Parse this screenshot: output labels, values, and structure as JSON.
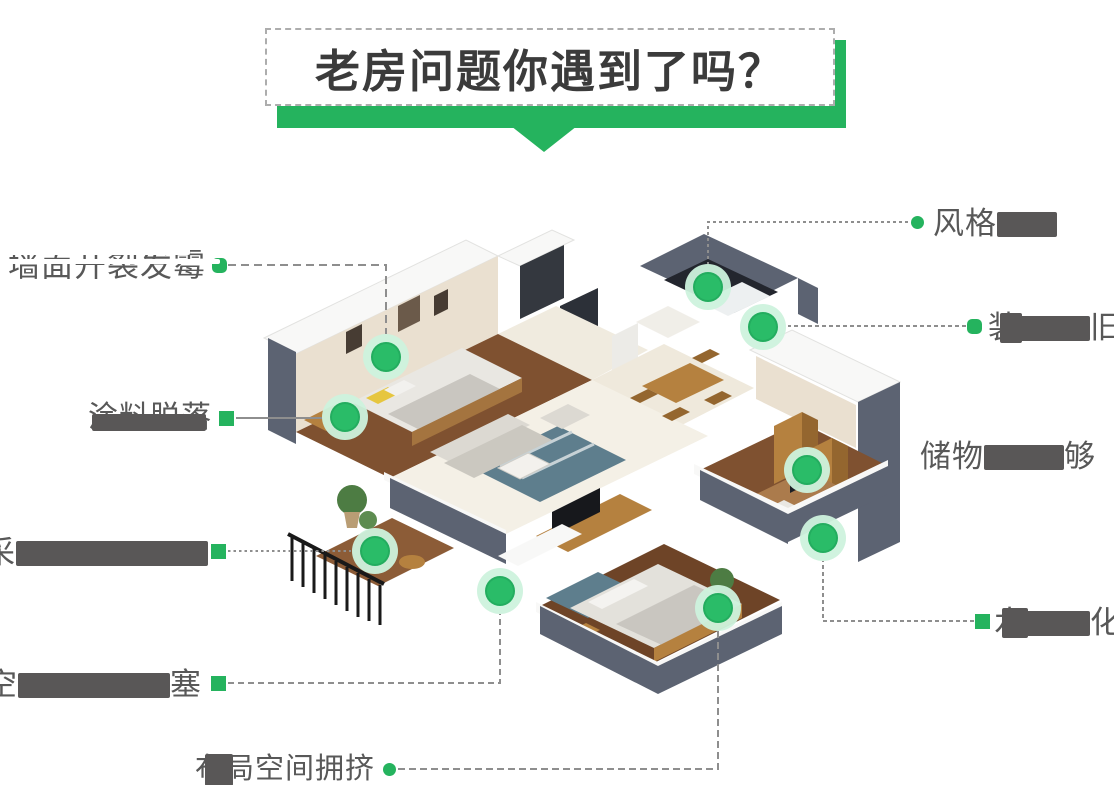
{
  "title": {
    "text": "老房问题你遇到了吗？"
  },
  "colors": {
    "green": "#25b35e",
    "marker_green": "#2abc68",
    "marker_ring": "#cdf2dd",
    "label_text": "#585858",
    "cover_block": "#595757",
    "connector_line": "#8e8e8e",
    "title_text": "#3b3b3b",
    "dashed_border": "#adadad"
  },
  "markers": [
    {
      "x": 386,
      "y": 357
    },
    {
      "x": 345,
      "y": 417
    },
    {
      "x": 375,
      "y": 551
    },
    {
      "x": 500,
      "y": 591
    },
    {
      "x": 708,
      "y": 287
    },
    {
      "x": 763,
      "y": 327
    },
    {
      "x": 807,
      "y": 470
    },
    {
      "x": 823,
      "y": 538
    },
    {
      "x": 718,
      "y": 608
    }
  ],
  "connectors": [
    {
      "path": "M228 265 H386 V334",
      "dash": "8 5"
    },
    {
      "path": "M236 418 H322",
      "dash": "none"
    },
    {
      "path": "M228 551 H351",
      "dash": "2.5 3"
    },
    {
      "path": "M228 683 H500 V614",
      "dash": "6 4"
    },
    {
      "path": "M398 769 H718 V631",
      "dash": "7 4"
    },
    {
      "path": "M908 222 H708 V264",
      "dash": "3 3"
    },
    {
      "path": "M966 326 H788",
      "dash": "4 3"
    },
    {
      "path": "M974 621 H823 V561",
      "dash": "4 3"
    }
  ],
  "dots": [
    {
      "shape": "rounded",
      "x": 219,
      "y": 265
    },
    {
      "shape": "square",
      "x": 226,
      "y": 418
    },
    {
      "shape": "square",
      "x": 218,
      "y": 551
    },
    {
      "shape": "square",
      "x": 218,
      "y": 683
    },
    {
      "shape": "circle",
      "x": 389,
      "y": 769
    },
    {
      "shape": "circle",
      "x": 917,
      "y": 222
    },
    {
      "shape": "rounded",
      "x": 974,
      "y": 326
    },
    {
      "shape": "square",
      "x": 982,
      "y": 621
    }
  ],
  "labels": [
    {
      "id": "wall-crack-mold",
      "x": 8,
      "y": 248,
      "f": 32,
      "segments": [
        {
          "t": "墙面开裂发霉"
        }
      ],
      "overlays": [
        {
          "c": "#ffffff",
          "x": -4,
          "y": -10,
          "w": 186,
          "h": 17
        },
        {
          "c": "#ffffff",
          "x": -4,
          "y": 11,
          "w": 216,
          "h": 5
        }
      ]
    },
    {
      "id": "paint-peeling",
      "x": 88,
      "y": 402,
      "f": 30,
      "segments": [
        {
          "t": "涂料脱落"
        }
      ],
      "overlays": [
        {
          "c": "#595757",
          "x": 4,
          "y": 12,
          "w": 114,
          "h": 17
        }
      ]
    },
    {
      "id": "poor-daylight",
      "x": -16,
      "y": 536,
      "f": 31,
      "segments": [
        {
          "t": "采"
        },
        {
          "b": 192
        }
      ],
      "overlays": []
    },
    {
      "id": "pipes-clogged",
      "x": -14,
      "y": 668,
      "f": 31,
      "segments": [
        {
          "t": "空"
        },
        {
          "b": 152
        },
        {
          "t": "塞"
        }
      ],
      "overlays": []
    },
    {
      "id": "layout-crowded",
      "x": 195,
      "y": 754,
      "f": 29,
      "segments": [
        {
          "t": "布局空间拥挤"
        }
      ],
      "overlays": [
        {
          "c": "#595757",
          "x": 10,
          "y": 0,
          "w": 28,
          "h": 32
        }
      ]
    },
    {
      "id": "style-outdated",
      "x": 933,
      "y": 207,
      "f": 31,
      "segments": [
        {
          "t": "风格"
        },
        {
          "b": 60
        }
      ],
      "overlays": []
    },
    {
      "id": "decor-old",
      "x": 988,
      "y": 311,
      "f": 31,
      "segments": [
        {
          "t": "装"
        },
        {
          "b": 70
        },
        {
          "t": "旧"
        }
      ],
      "overlays": [
        {
          "c": "#595757",
          "x": 12,
          "y": 2,
          "w": 22,
          "h": 30
        }
      ]
    },
    {
      "id": "storage-not-enough",
      "x": 920,
      "y": 440,
      "f": 31,
      "segments": [
        {
          "t": "储物"
        },
        {
          "b": 80
        },
        {
          "t": "够"
        }
      ],
      "overlays": []
    },
    {
      "id": "plumbing-wiring-aged",
      "x": 994,
      "y": 606,
      "f": 31,
      "segments": [
        {
          "t": "水"
        },
        {
          "b": 64
        },
        {
          "t": "化"
        }
      ],
      "overlays": [
        {
          "c": "#595757",
          "x": 8,
          "y": 2,
          "w": 26,
          "h": 30
        }
      ]
    }
  ]
}
